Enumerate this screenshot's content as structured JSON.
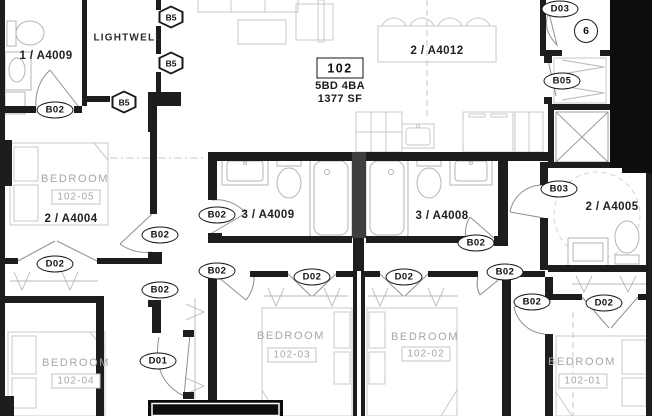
{
  "unit": {
    "number": "102",
    "bed_bath": "5BD 4BA",
    "area": "1377 SF"
  },
  "rooms": {
    "lightwell": "LIGHTWELL",
    "bedrooms": [
      {
        "label": "BEDROOM",
        "number": "102-05"
      },
      {
        "label": "BEDROOM",
        "number": "102-04"
      },
      {
        "label": "BEDROOM",
        "number": "102-03"
      },
      {
        "label": "BEDROOM",
        "number": "102-02"
      },
      {
        "label": "BEDROOM",
        "number": "102-01"
      }
    ]
  },
  "callouts": {
    "bath_top_left": "1 / A4009",
    "bedroom_5": "2 / A4004",
    "bath_mid_left": "3 / A4009",
    "bath_mid_right": "3 / A4008",
    "kitchen": "2 / A4012",
    "bath_right": "2 / A4005"
  },
  "tags": {
    "b02": "B02",
    "d02": "D02",
    "d01": "D01",
    "d03": "D03",
    "b05": "B05",
    "b03": "B03",
    "b5": "B5",
    "keynote_6": "6"
  },
  "colors": {
    "wall": "#1d1d1f",
    "poche": "#0d0d0d",
    "label_gray": "#a6a6a6"
  }
}
